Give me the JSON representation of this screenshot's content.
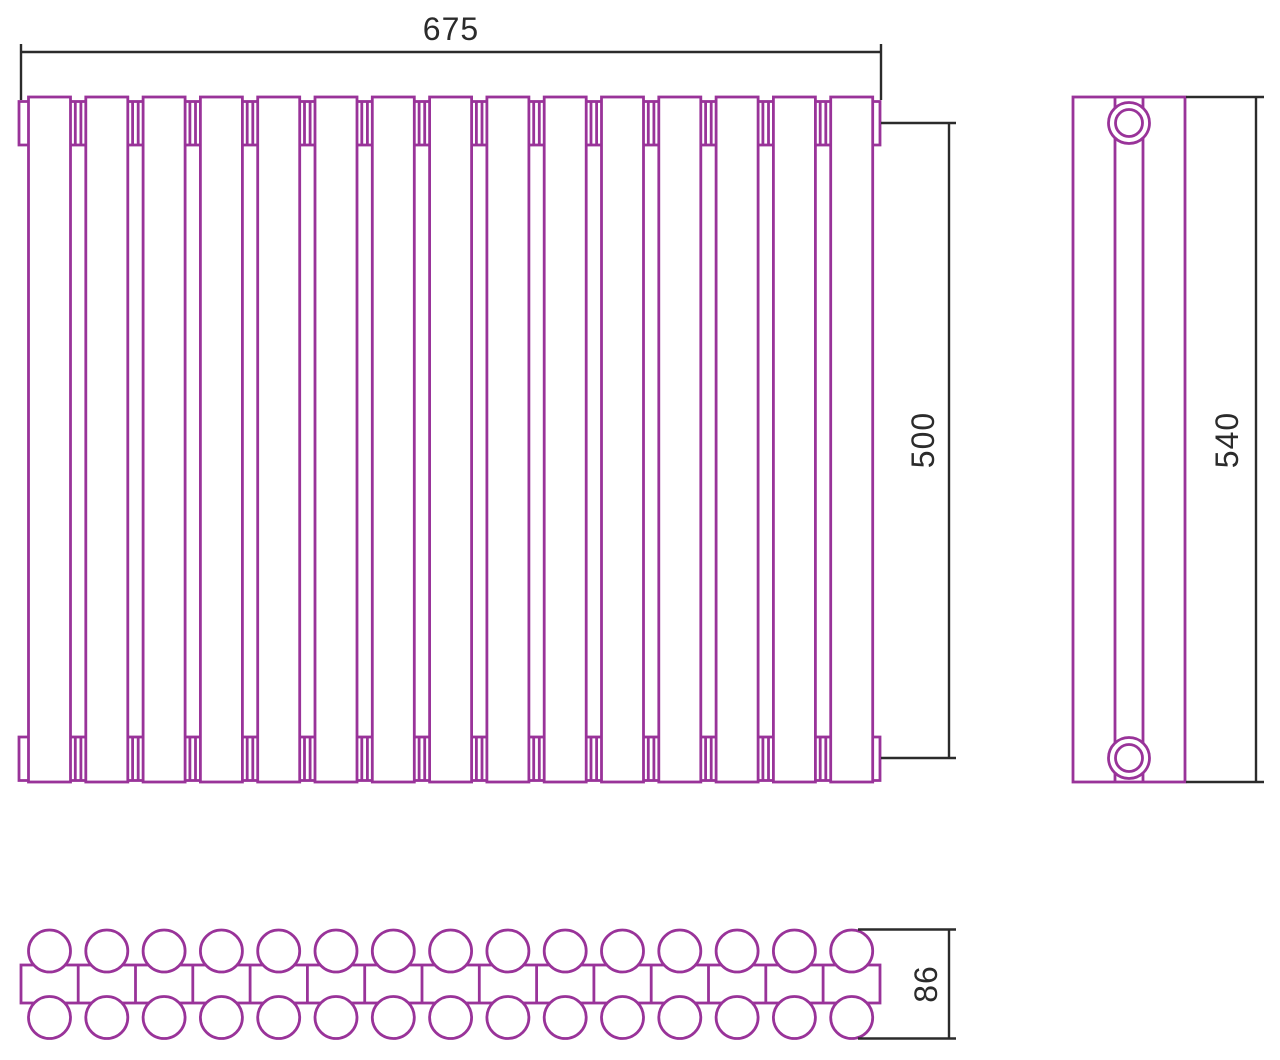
{
  "drawing": {
    "type": "technical-dimensional-drawing",
    "subject": "tubular sectional radiator, three orthographic views",
    "background": "#ffffff",
    "line_color": "#993399",
    "dimension_color": "#2b2b2b",
    "front_view": {
      "sections": 15,
      "width_label": "675",
      "height_label": "500"
    },
    "side_view": {
      "height_label": "540",
      "connection_ports": 2
    },
    "top_view": {
      "tube_rows": 2,
      "tubes_per_row": 15,
      "depth_label": "86"
    }
  }
}
